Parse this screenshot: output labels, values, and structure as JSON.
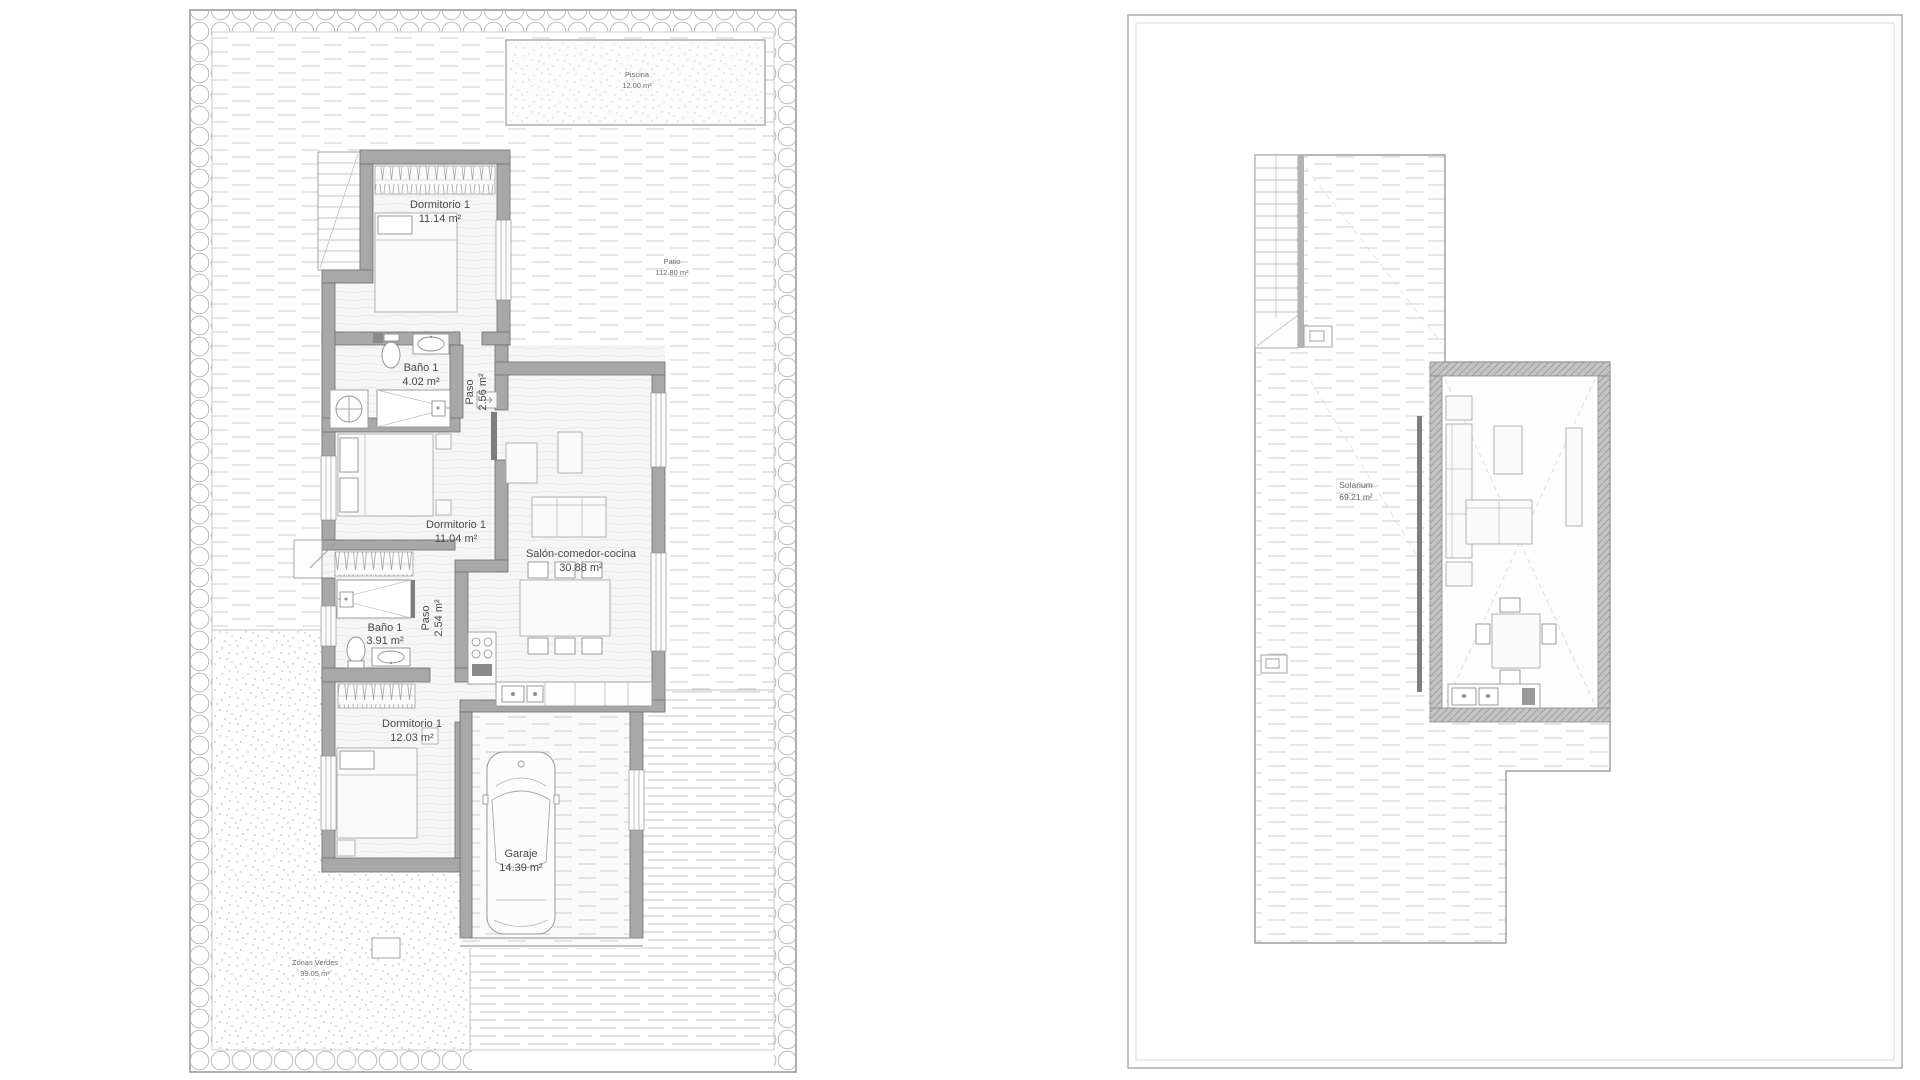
{
  "document": {
    "type": "architectural floor plan",
    "language": "es",
    "views": [
      "Planta baja con parcela",
      "Planta solarium"
    ]
  },
  "colors": {
    "background": "#ffffff",
    "wall_fill": "#a8a8a8",
    "wall_stroke": "#6f6f6f",
    "texture_line": "#c9c9c9",
    "outline": "#9a9a9a",
    "label_text": "#4a4a4a"
  },
  "plans": [
    {
      "id": "ground-floor",
      "rooms": [
        {
          "name": "Piscina",
          "area": "12.00 m²"
        },
        {
          "name": "Patio",
          "area": "112.80 m²"
        },
        {
          "name": "Dormitorio 1",
          "area": "11.14 m²"
        },
        {
          "name": "Baño 1",
          "area": "4.02 m²"
        },
        {
          "name": "Paso",
          "area": "2.56 m²"
        },
        {
          "name": "Dormitorio 1",
          "area": "11.04 m²"
        },
        {
          "name": "Salón-comedor-cocina",
          "area": "30.88 m²"
        },
        {
          "name": "Baño 1",
          "area": "3.91 m²"
        },
        {
          "name": "Paso",
          "area": "2.54 m²"
        },
        {
          "name": "Dormitorio 1",
          "area": "12.03 m²"
        },
        {
          "name": "Garaje",
          "area": "14.39 m²"
        },
        {
          "name": "Zonas Verdes",
          "area": "99.05 m²"
        }
      ]
    },
    {
      "id": "solarium-floor",
      "rooms": [
        {
          "name": "Solarium",
          "area": "69.21 m²"
        }
      ]
    }
  ]
}
